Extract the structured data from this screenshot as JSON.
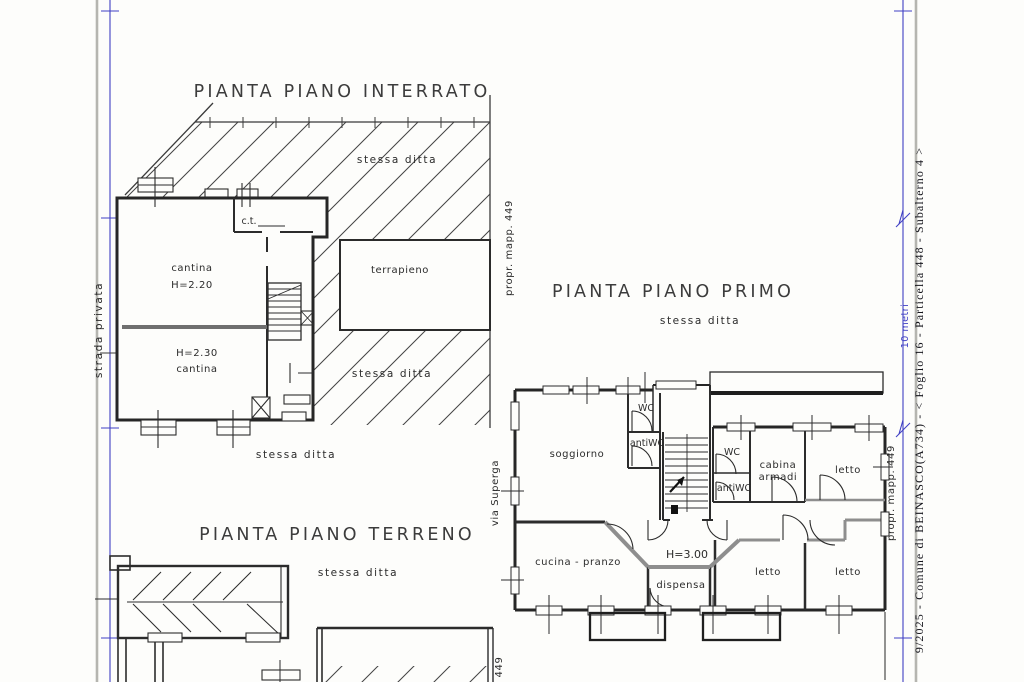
{
  "page": {
    "margin_right_text": "9/2025 - Comune di BEINASCO(A734) - < Foglio 16 - Particella 448 - Subalterno 4 >",
    "scale_label": "10 metri",
    "street_left": "strada privata",
    "street_via": "via Superga"
  },
  "colors": {
    "ink": "#2b2b2b",
    "wall_gray": "#8e8e8e",
    "blue": "#4040c4",
    "border_gray": "#b5b5b0"
  },
  "plan_interrato": {
    "title": "PIANTA PIANO INTERRATO",
    "labels": {
      "stessa_ditta_top": "stessa ditta",
      "stessa_ditta_right": "stessa ditta",
      "stessa_ditta_bottom": "stessa ditta",
      "ct": "c.t.",
      "cantina_up_name": "cantina",
      "cantina_up_h": "H=2.20",
      "cantina_low_h": "H=2.30",
      "cantina_low_name": "cantina",
      "terrapieno": "terrapieno",
      "propr_mapp": "propr. mapp. 449"
    }
  },
  "plan_primo": {
    "title": "PIANTA PIANO PRIMO",
    "labels": {
      "stessa_ditta": "stessa ditta",
      "soggiorno": "soggiorno",
      "wc_top": "WC",
      "antiwc_top": "antiWC",
      "wc_mid": "WC",
      "antiwc_mid": "antiWC",
      "cabina_line1": "cabina",
      "cabina_line2": "armadi",
      "letto_ne": "letto",
      "cucina": "cucina  -  pranzo",
      "altezza": "H=3.00",
      "dispensa": "dispensa",
      "letto_s1": "letto",
      "letto_s2": "letto",
      "propr_mapp": "propr. mapp. 449"
    }
  },
  "plan_terreno": {
    "title": "PIANTA PIANO TERRENO",
    "labels": {
      "stessa_ditta": "stessa ditta",
      "mapp": "449"
    }
  }
}
